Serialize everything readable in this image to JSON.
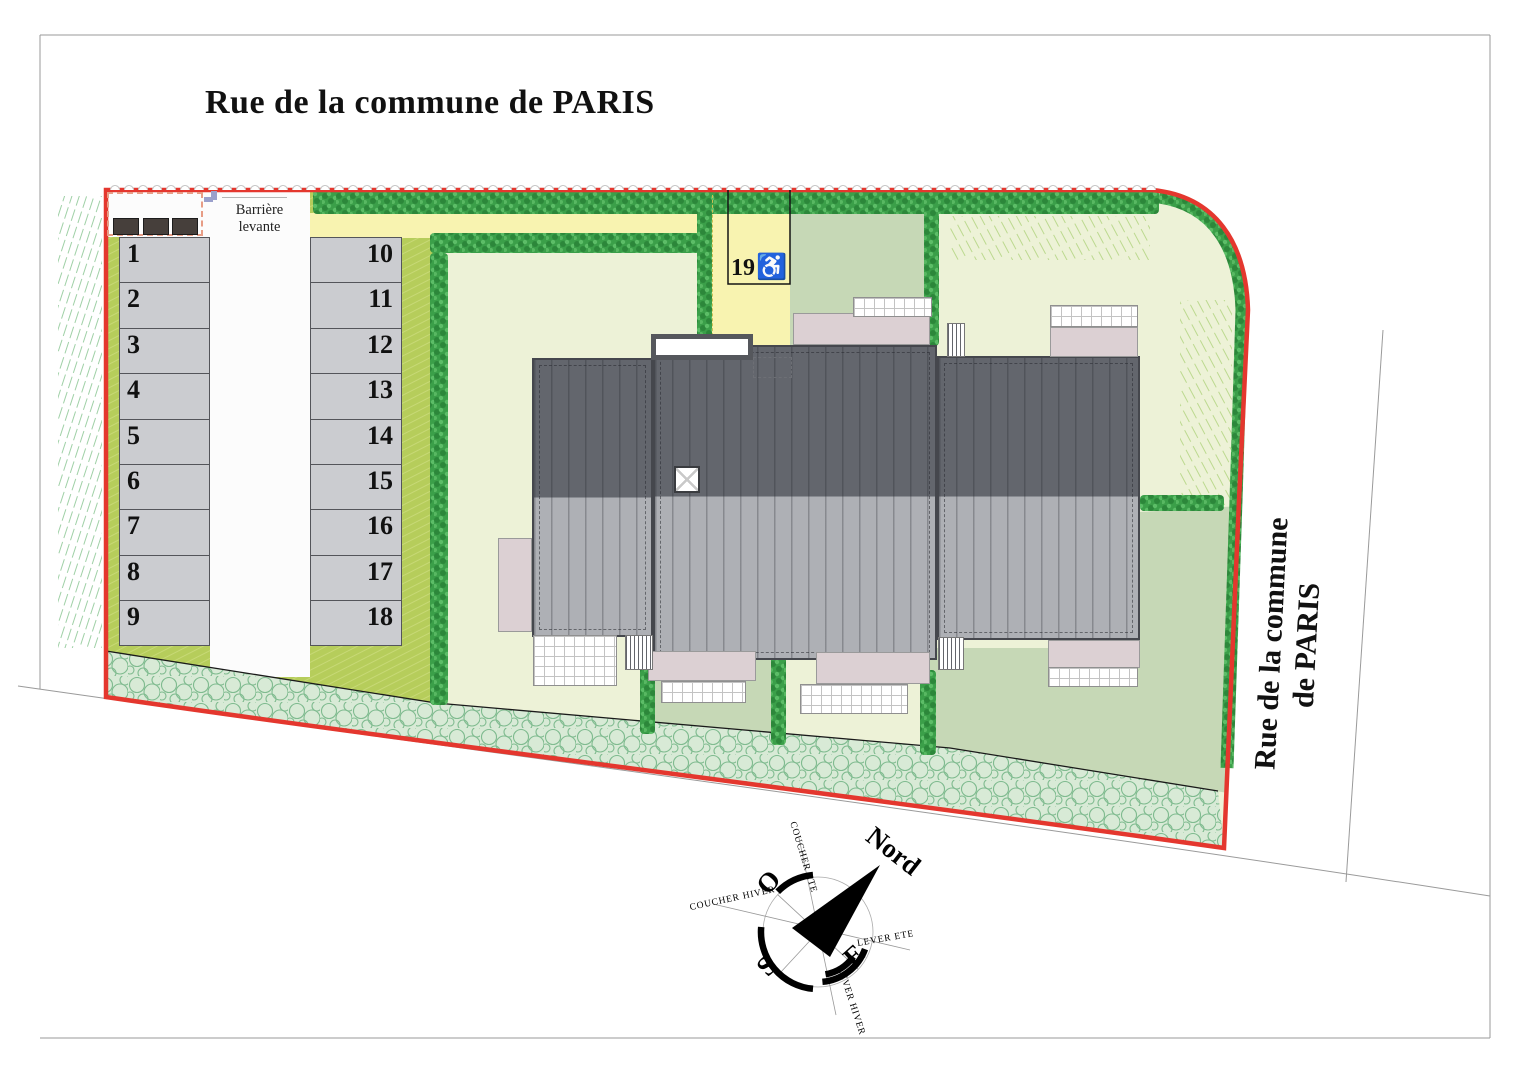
{
  "title": "Rue de la commune de PARIS",
  "street_label_right": {
    "line1": "Rue de la commune",
    "line2": "de PARIS"
  },
  "barrier": {
    "line1": "Barrière",
    "line2": "levante"
  },
  "parking": {
    "left": [
      "1",
      "2",
      "3",
      "4",
      "5",
      "6",
      "7",
      "8",
      "9"
    ],
    "right": [
      "10",
      "11",
      "12",
      "13",
      "14",
      "15",
      "16",
      "17",
      "18"
    ],
    "accessible": {
      "label": "19",
      "symbol": "♿"
    }
  },
  "compass": {
    "north": "Nord",
    "west": "O",
    "south": "S",
    "east": "E",
    "summer_sunset": "COUCHER ETE",
    "winter_sunset": "COUCHER HIVER",
    "summer_sunrise": "LEVER ETE",
    "winter_sunrise": "LEVER HIVER"
  },
  "colors": {
    "boundary_red": "#e4372e",
    "lawn_pale": "#edf2d7",
    "garden_green": "#c6d8b6",
    "verge_olive": "#b6cd5b",
    "drive_yellow": "#f8f3b0",
    "hedge_green": "#3b9f49",
    "roof_dark": "#63666d",
    "roof_light": "#aeb0b5",
    "patio_pink": "#dcd0d3",
    "shrub_fill": "#d8ead6"
  }
}
